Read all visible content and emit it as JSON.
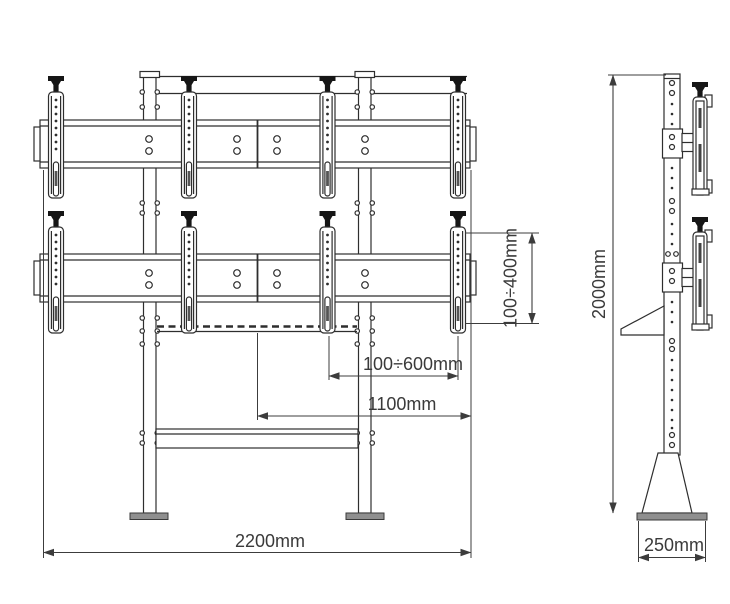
{
  "drawing": {
    "dimensions": {
      "bracket_height_range": "100÷400mm",
      "bracket_spacing_range": "100÷600mm",
      "half_width": "1100mm",
      "total_width": "2200mm",
      "total_height": "2000mm",
      "base_depth": "250mm"
    },
    "colors": {
      "line": "#2e2e2e",
      "dimension": "#3c3c3c",
      "foot_fill": "#8f8f8f",
      "background": "#ffffff"
    }
  }
}
